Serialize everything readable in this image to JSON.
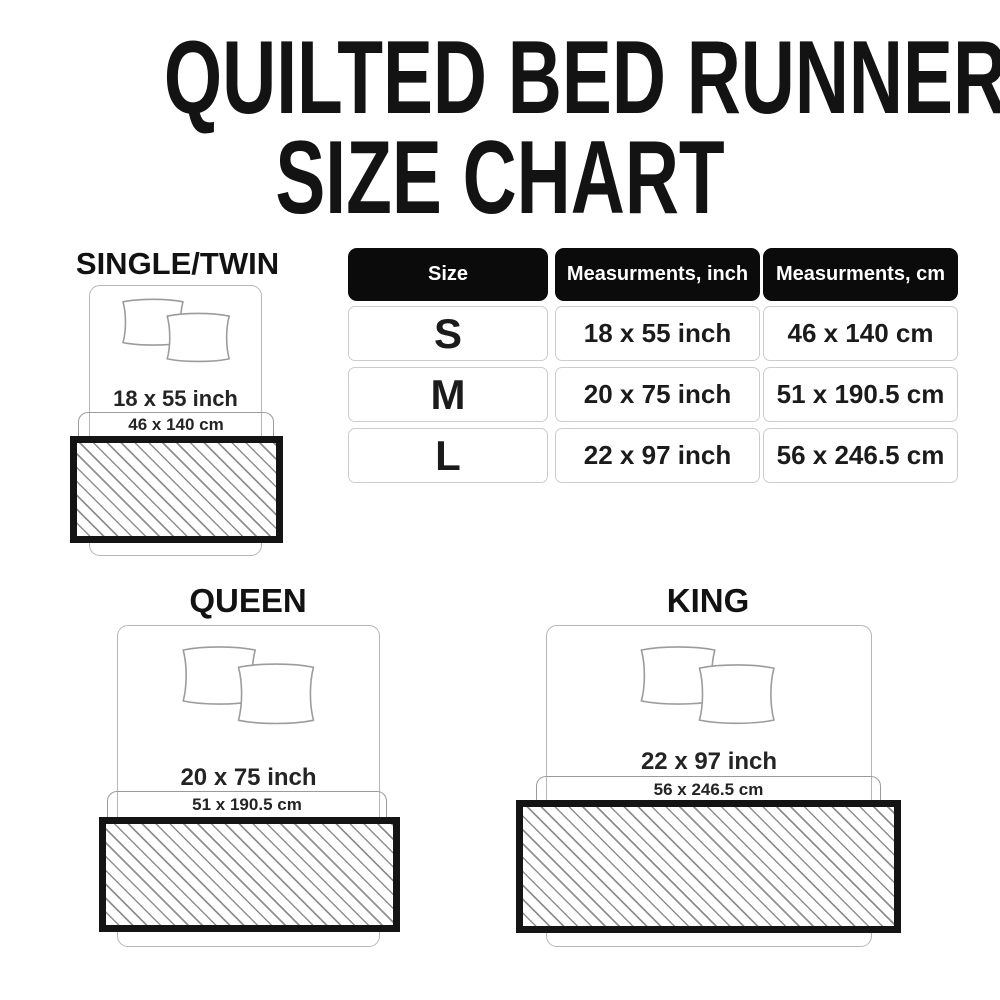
{
  "title": {
    "line1": "QUILTED BED RUNNER",
    "line2": "SIZE CHART"
  },
  "table": {
    "headers": [
      "Size",
      "Measurments, inch",
      "Measurments, cm"
    ],
    "rows": [
      {
        "size": "S",
        "inch": "18 x 55 inch",
        "cm": "46 x 140 cm"
      },
      {
        "size": "M",
        "inch": "20 x 75 inch",
        "cm": "51 x 190.5 cm"
      },
      {
        "size": "L",
        "inch": "22 x 97 inch",
        "cm": "56 x 246.5 cm"
      }
    ]
  },
  "sections": {
    "single": {
      "label": "SINGLE/TWIN",
      "inch": "18 x 55 inch",
      "cm": "46 x 140 cm"
    },
    "queen": {
      "label": "QUEEN",
      "inch": "20 x 75 inch",
      "cm": "51 x 190.5 cm"
    },
    "king": {
      "label": "KING",
      "inch": "22 x 97 inch",
      "cm": "56 x 246.5 cm"
    }
  },
  "colors": {
    "background": "#ffffff",
    "title_text": "#131313",
    "table_header_bg": "#0b0b0b",
    "table_header_text": "#ffffff",
    "table_cell_border": "#c9cdd2",
    "bed_outline": "#b6b6b6",
    "bracket_outline": "#9a9a9a",
    "runner_border": "#141414",
    "hatch_line": "#8f8f8f"
  }
}
